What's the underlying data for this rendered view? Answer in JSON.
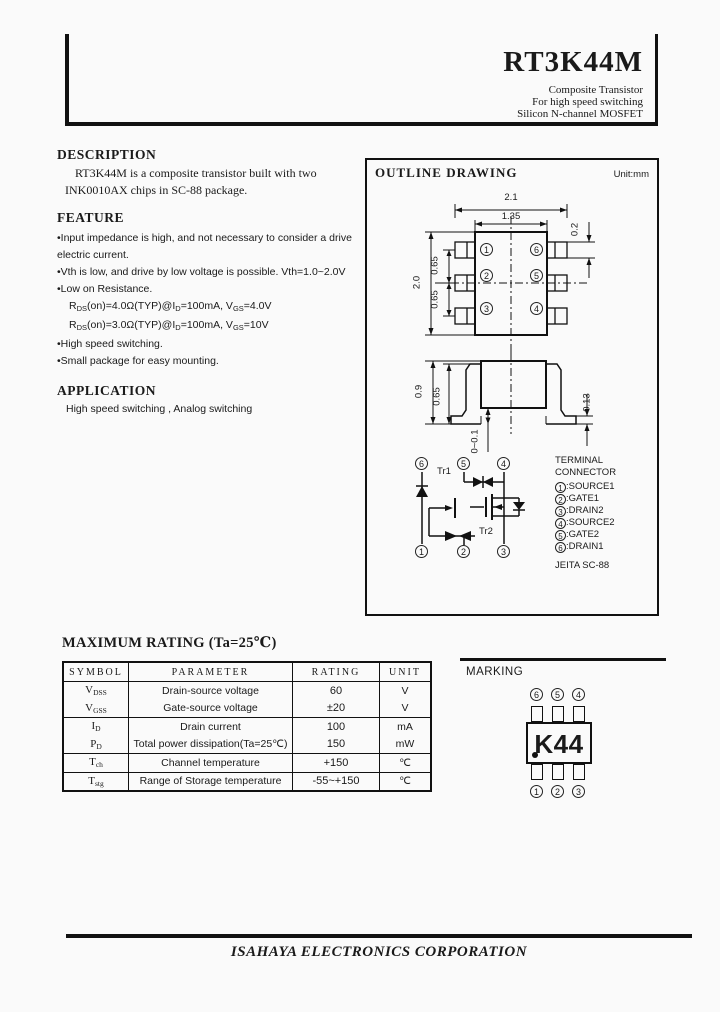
{
  "header": {
    "title": "RT3K44M",
    "sub": [
      "Composite Transistor",
      "For high speed switching",
      "Silicon N-channel MOSFET"
    ]
  },
  "description": {
    "heading": "DESCRIPTION",
    "line1": "RT3K44M is a composite transistor built with two",
    "line2": "INK0010AX  chips in SC-88 package."
  },
  "feature": {
    "heading": "FEATURE",
    "b1a": "•Input impedance is high, and not necessary to consider a drive",
    "b1b": "electric current.",
    "b2": "•Vth is low, and drive by low voltage is possible. Vth=1.0~2.0V",
    "b3": "•Low on Resistance.",
    "rds1": {
      "p0": "R",
      "p1": "DS",
      "p2": "(on)=4.0Ω(TYP)@I",
      "p3": "D",
      "p4": "=100mA, V",
      "p5": "GS",
      "p6": "=4.0V"
    },
    "rds2": {
      "p0": "R",
      "p1": "DS",
      "p2": "(on)=3.0Ω(TYP)@I",
      "p3": "D",
      "p4": "=100mA, V",
      "p5": "GS",
      "p6": "=10V"
    },
    "b5": "•High speed switching.",
    "b6": "•Small package for easy mounting."
  },
  "application": {
    "heading": "APPLICATION",
    "text": "High speed switching , Analog switching"
  },
  "outline": {
    "title": "OUTLINE DRAWING",
    "unit": "Unit:mm",
    "top": {
      "d21": "2.1",
      "d135": "1.35",
      "d20": "2.0",
      "p65a": "0.65",
      "p65b": "0.65",
      "d02": "0.2",
      "lpins": [
        "1",
        "2",
        "3"
      ],
      "rpins": [
        "6",
        "5",
        "4"
      ]
    },
    "side": {
      "d09": "0.9",
      "d065": "0.65",
      "d001": "0~0.1",
      "d013": "0.13"
    },
    "sch": {
      "tr1": "Tr1",
      "tr2": "Tr2",
      "top": [
        "6",
        "5",
        "4"
      ],
      "bot": [
        "1",
        "2",
        "3"
      ]
    },
    "term": {
      "t1": "TERMINAL",
      "t2": "CONNECTOR",
      "nums": [
        "1",
        "2",
        "3",
        "4",
        "5",
        "6"
      ],
      "items": [
        ":SOURCE1",
        ":GATE1",
        ":DRAIN2",
        ":SOURCE2",
        ":GATE2",
        ":DRAIN1"
      ],
      "jeita": "JEITA SC-88"
    }
  },
  "rating": {
    "heading": "MAXIMUM RATING (Ta=25℃)",
    "cols": [
      "SYMBOL",
      "PARAMETER",
      "RATING",
      "UNIT"
    ],
    "rows": [
      {
        "sym_base": "V",
        "sym_sub": "DSS",
        "param": "Drain-source voltage",
        "rating": "60",
        "unit": "V"
      },
      {
        "sym_base": "V",
        "sym_sub": "GSS",
        "param": "Gate-source voltage",
        "rating": "±20",
        "unit": "V"
      },
      {
        "sym_base": "I",
        "sym_sub": "D",
        "param": "Drain current",
        "rating": "100",
        "unit": "mA"
      },
      {
        "sym_base": "P",
        "sym_sub": "D",
        "param": "Total power dissipation(Ta=25℃)",
        "rating": "150",
        "unit": "mW"
      },
      {
        "sym_base": "T",
        "sym_sub": "ch",
        "param": "Channel temperature",
        "rating": "+150",
        "unit": "℃"
      },
      {
        "sym_base": "T",
        "sym_sub": "stg",
        "param": "Range of Storage temperature",
        "rating": "-55~+150",
        "unit": "℃"
      }
    ]
  },
  "marking": {
    "label": "MARKING",
    "code": "K44",
    "top": [
      "6",
      "5",
      "4"
    ],
    "bot": [
      "1",
      "2",
      "3"
    ]
  },
  "footer": {
    "company": "ISAHAYA ELECTRONICS CORPORATION"
  }
}
